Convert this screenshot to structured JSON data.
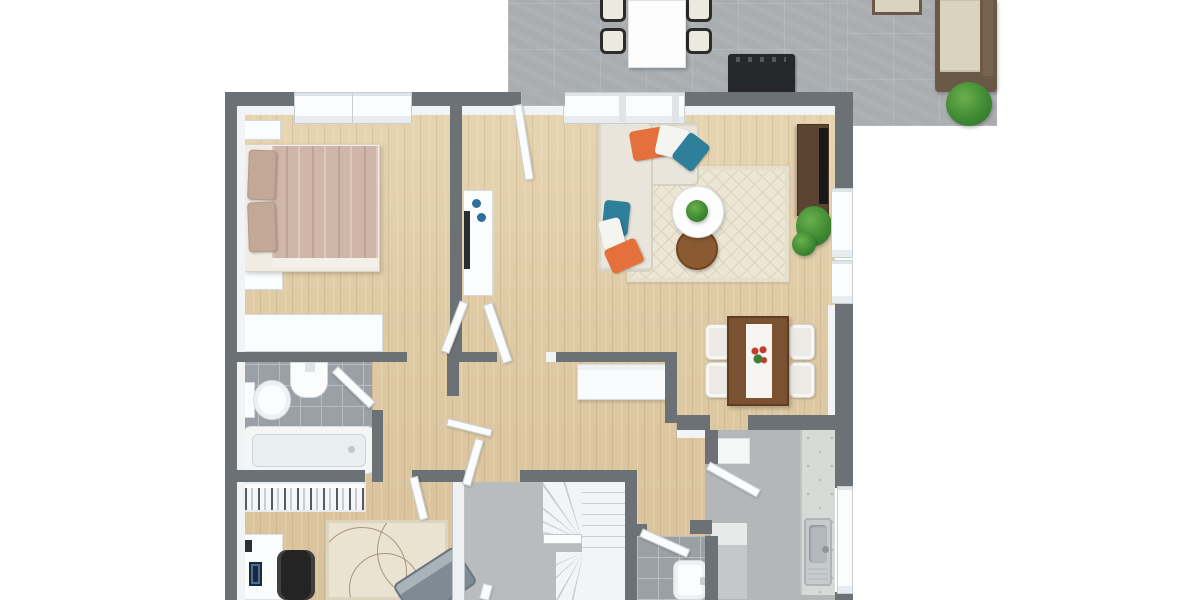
{
  "title": "3D floor plan rendering — top-down view, first floor with patio",
  "view": {
    "type": "3d-floor-plan",
    "projection": "top-down",
    "background": "#ffffff"
  },
  "palette": {
    "wood_floor": "#ddc8a4",
    "wall_dark": "#6b7175",
    "wall_cap_white": "#f1f3f4",
    "patio_tile": "#a9adb0",
    "bath_tile": "#9aa0a5",
    "entry_floor": "#b9bcbd",
    "kitchen_floor": "#b4b7b8",
    "living_rug": "#ece6d6",
    "sofa_cream": "#e9e5da",
    "pillow_orange": "#e4703b",
    "pillow_teal": "#2e7f99",
    "bedding_rose_tan": "#cfb6a9",
    "dining_table_brown": "#7b5231",
    "tv_cabinet_brown": "#5c4432",
    "plant_green": "#3f8a34",
    "office_couch_gray": "#7e8b94",
    "fixture_white": "#f7f9f9",
    "outdoor_sofa_frame": "#6a5947",
    "outdoor_cushion": "#d9d3c0",
    "grill_black": "#26282b",
    "flower_red": "#c43a2e"
  },
  "rooms": {
    "patio": {
      "name": "Patio / terrace",
      "floor": "gray tile",
      "furniture": [
        "outdoor dining table",
        "4 outdoor chairs",
        "grill",
        "outdoor sectional sofa",
        "ottoman",
        "potted plant"
      ]
    },
    "bedroom": {
      "name": "Bedroom",
      "floor": "light wood",
      "furniture": [
        "double bed with rose-tan bedding",
        "2 pillows",
        "2 nightstands",
        "low dresser",
        "2 windows"
      ]
    },
    "hallway": {
      "name": "Hallway",
      "floor": "light wood",
      "furniture": [
        "white sideboard with decor",
        "white console below living-room wall"
      ]
    },
    "living_room": {
      "name": "Living room",
      "floor": "light wood",
      "furniture": [
        "L-shaped cream sectional sofa",
        "6 throw pillows (orange, white, teal)",
        "round white coffee table with plant",
        "round brown side table",
        "cream diamond-pattern rug",
        "dark brown TV cabinet with TV",
        "potted plant",
        "triple window",
        "2 side windows"
      ]
    },
    "dining_area": {
      "name": "Dining area",
      "floor": "light wood",
      "furniture": [
        "brown dining table with white runner",
        "red flower centerpiece",
        "4 white chairs"
      ]
    },
    "bathroom": {
      "name": "Bathroom",
      "floor": "gray tile",
      "furniture": [
        "bathtub",
        "toilet",
        "wall-mounted sink"
      ]
    },
    "home_office": {
      "name": "Home office",
      "floor": "light wood",
      "furniture": [
        "white desk",
        "smartphone",
        "black office chair",
        "white storage shelf",
        "cream rug with circle pattern",
        "gray loveseat"
      ]
    },
    "entry": {
      "name": "Entry / landing",
      "floor": "plain gray"
    },
    "stairwell": {
      "name": "Winder staircase",
      "floor": "white treads"
    },
    "wc": {
      "name": "Small bathroom / WC",
      "floor": "gray tile",
      "furniture": [
        "washbasin with faucet"
      ]
    },
    "kitchen": {
      "name": "Kitchen",
      "floor": "plain gray",
      "furniture": [
        "counter run with stainless sink",
        "tall cabinet",
        "window strip"
      ]
    }
  },
  "doors": {
    "front_door": "Front door to patio (open leaf)",
    "bedroom_door": "Bedroom door (open leaf)",
    "bathroom_door": "Bathroom door (open leaf)",
    "hall_living_door": "Hall to living area door (open leaf)",
    "entry_door": "Hall to entry door (open leaf)",
    "office_door": "Office door (open leaf)",
    "kitchen_door": "Dining to kitchen door (open leaf)",
    "wc_door": "WC door (open leaf)"
  },
  "counts": {
    "windows_top": 3,
    "windows_right": 3,
    "dining_chairs": 4,
    "patio_chairs": 4,
    "throw_pillows": 6
  }
}
